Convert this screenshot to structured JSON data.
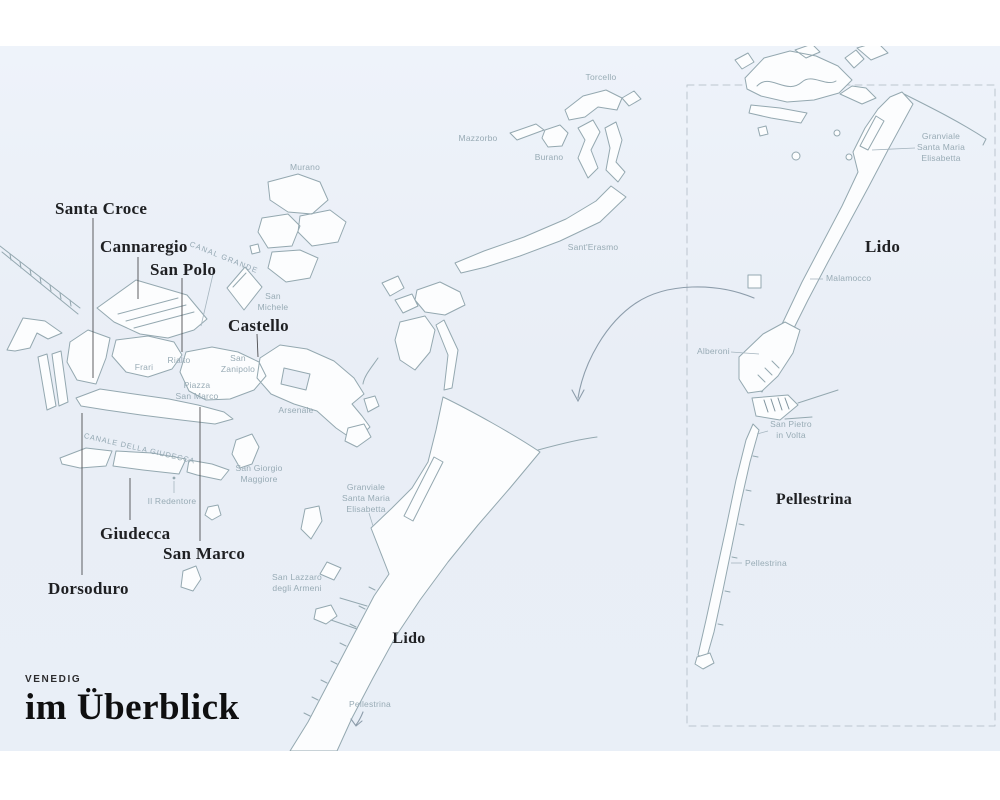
{
  "title": {
    "kicker": "VENEDIG",
    "heading": "im Überblick"
  },
  "colors": {
    "background": "#e9eef6",
    "island_fill": "#fcfdfe",
    "island_stroke": "#94a8b0",
    "small_label": "#98abb5",
    "district_label": "#1f2023",
    "dashed_border": "#bcc5cf",
    "arrow": "#8d9dab"
  },
  "district_labels": {
    "santa_croce": "Santa Croce",
    "cannaregio": "Cannaregio",
    "san_polo": "San Polo",
    "castello": "Castello",
    "giudecca": "Giudecca",
    "san_marco": "San Marco",
    "dorsoduro": "Dorsoduro"
  },
  "island_labels": {
    "lido_main": "Lido",
    "lido_inset": "Lido",
    "pellestrina_inset": "Pellestrina"
  },
  "place_labels": {
    "murano": "Murano",
    "mazzorbo": "Mazzorbo",
    "burano": "Burano",
    "torcello": "Torcello",
    "sant_erasmo": "Sant'Erasmo",
    "san_michele": {
      "l1": "San",
      "l2": "Michele"
    },
    "rialto": "Rialto",
    "frari": "Frari",
    "san_zanipolo": {
      "l1": "San",
      "l2": "Zanipolo"
    },
    "piazza_san_marco": {
      "l1": "Piazza",
      "l2": "San Marco"
    },
    "arsenale": "Arsenale",
    "san_giorgio": {
      "l1": "San Giorgio",
      "l2": "Maggiore"
    },
    "il_redentore": "Il Redentore",
    "san_lazzaro": {
      "l1": "San Lazzaro",
      "l2": "degli Armeni"
    },
    "granviale_main": {
      "l1": "Granviale",
      "l2": "Santa Maria",
      "l3": "Elisabetta"
    },
    "pellestrina_main": "Pellestrina"
  },
  "waterway_labels": {
    "canal_grande": "CANAL GRANDE",
    "canale_della_giudecca": "CANALE DELLA GIUDECCA"
  },
  "inset_labels": {
    "granviale": {
      "l1": "Granviale",
      "l2": "Santa Maria",
      "l3": "Elisabetta"
    },
    "malamocco": "Malamocco",
    "alberoni": "Alberoni",
    "san_pietro_in_volta": {
      "l1": "San Pietro",
      "l2": "in Volta"
    },
    "pellestrina_small": "Pellestrina"
  }
}
